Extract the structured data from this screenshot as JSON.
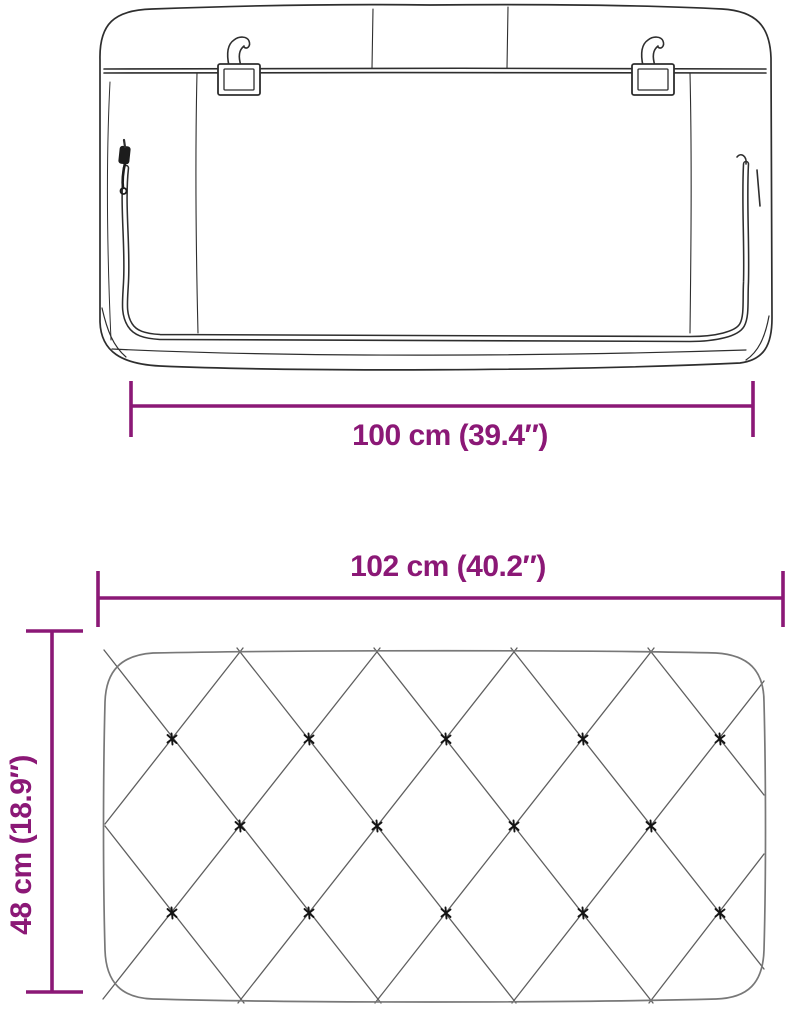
{
  "diagram": {
    "subject": "headboard-cushion-dimension-diagram",
    "colors": {
      "dimension": "#8b1876",
      "back_outline": "#2e2e2e",
      "front_outline": "#787878",
      "lattice": "#5f5f5f",
      "button": "#141414",
      "background": "#ffffff"
    },
    "back_view": {
      "name": "headboard back view with zipper and hanging brackets",
      "dimension_width": {
        "label": "100 cm (39.4″)"
      }
    },
    "front_view": {
      "name": "headboard front view with diamond tufting",
      "dimension_width": {
        "label": "102 cm (40.2″)"
      },
      "dimension_height": {
        "label": "48 cm (18.9″)"
      }
    }
  }
}
